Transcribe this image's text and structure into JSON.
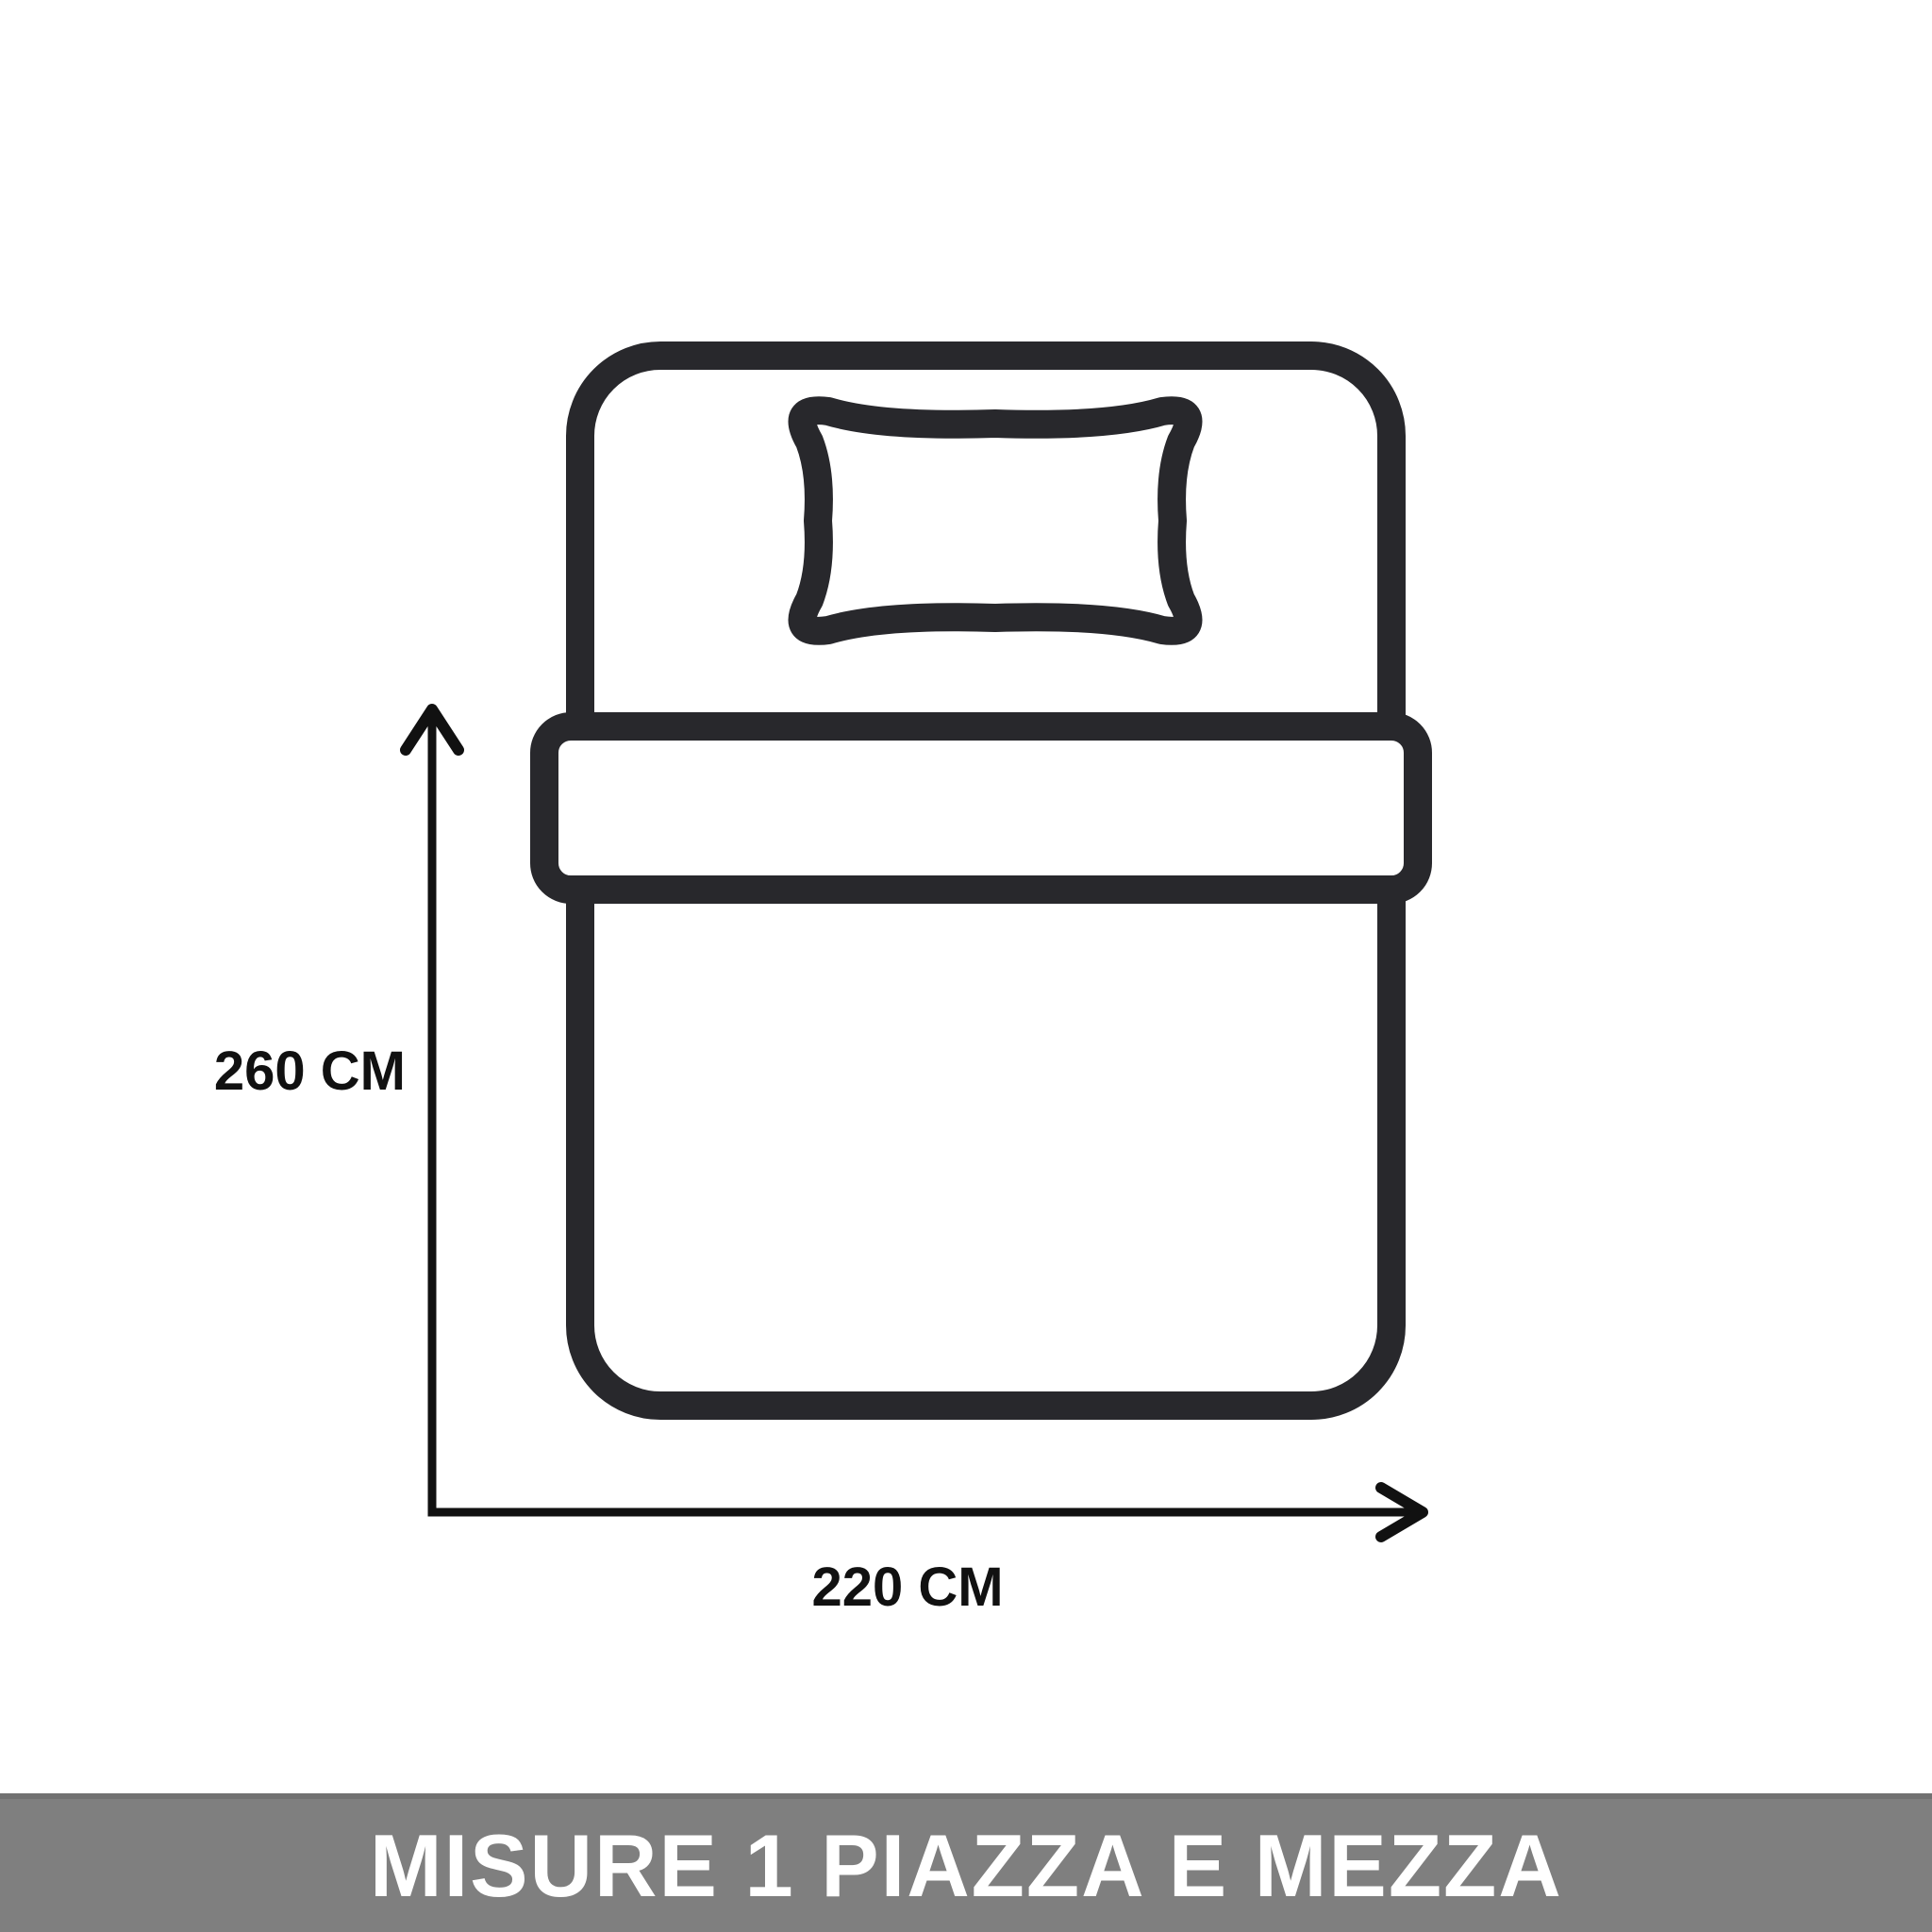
{
  "diagram": {
    "height_label": "260 CM",
    "width_label": "220 CM",
    "outline_color": "#28282c",
    "dimension_color": "#111111"
  },
  "banner": {
    "title": "MISURE 1 PIAZZA E MEZZA",
    "background": "#7f7f7f",
    "text_color": "#ffffff"
  }
}
